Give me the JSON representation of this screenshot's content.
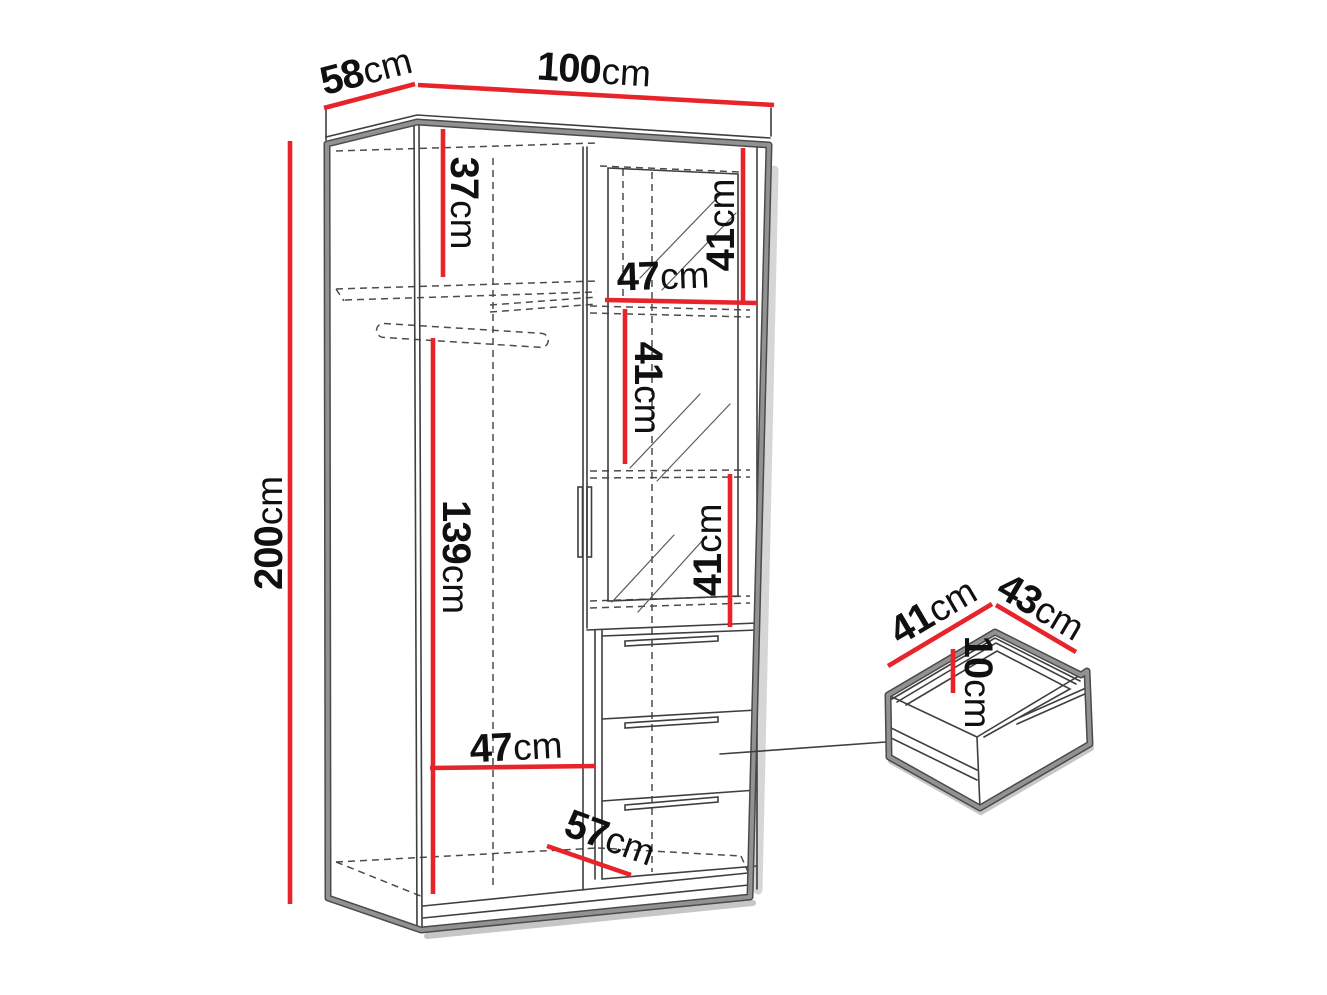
{
  "diagram_type": "wardrobe-dimension-drawing",
  "colors": {
    "background": "#ffffff",
    "dimension_line": "#e8242b",
    "outline_dark": "#4a4a4a",
    "outline_gray": "#929292",
    "hidden_line": "#4c4c4c",
    "label_text": "#101010"
  },
  "labels": {
    "d58": {
      "num": "58",
      "unit": "cm"
    },
    "d100": {
      "num": "100",
      "unit": "cm"
    },
    "d200": {
      "num": "200",
      "unit": "cm"
    },
    "d37": {
      "num": "37",
      "unit": "cm"
    },
    "d41a": {
      "num": "41",
      "unit": "cm"
    },
    "d47a": {
      "num": "47",
      "unit": "cm"
    },
    "d41b": {
      "num": "41",
      "unit": "cm"
    },
    "d41c": {
      "num": "41",
      "unit": "cm"
    },
    "d139": {
      "num": "139",
      "unit": "cm"
    },
    "d47b": {
      "num": "47",
      "unit": "cm"
    },
    "d57": {
      "num": "57",
      "unit": "cm"
    },
    "dd41": {
      "num": "41",
      "unit": "cm"
    },
    "dd43": {
      "num": "43",
      "unit": "cm"
    },
    "dd10": {
      "num": "10",
      "unit": "cm"
    }
  },
  "wardrobe_dimensions_cm": {
    "depth": 58,
    "width": 100,
    "height": 200,
    "top_shelf_gap": 37,
    "right_sections": [
      41,
      41,
      41
    ],
    "right_section_width": 47,
    "hanging_space": 139,
    "interior_width": 47,
    "interior_depth": 57
  },
  "drawer_dimensions_cm": {
    "depth": 41,
    "width": 43,
    "height": 10
  }
}
